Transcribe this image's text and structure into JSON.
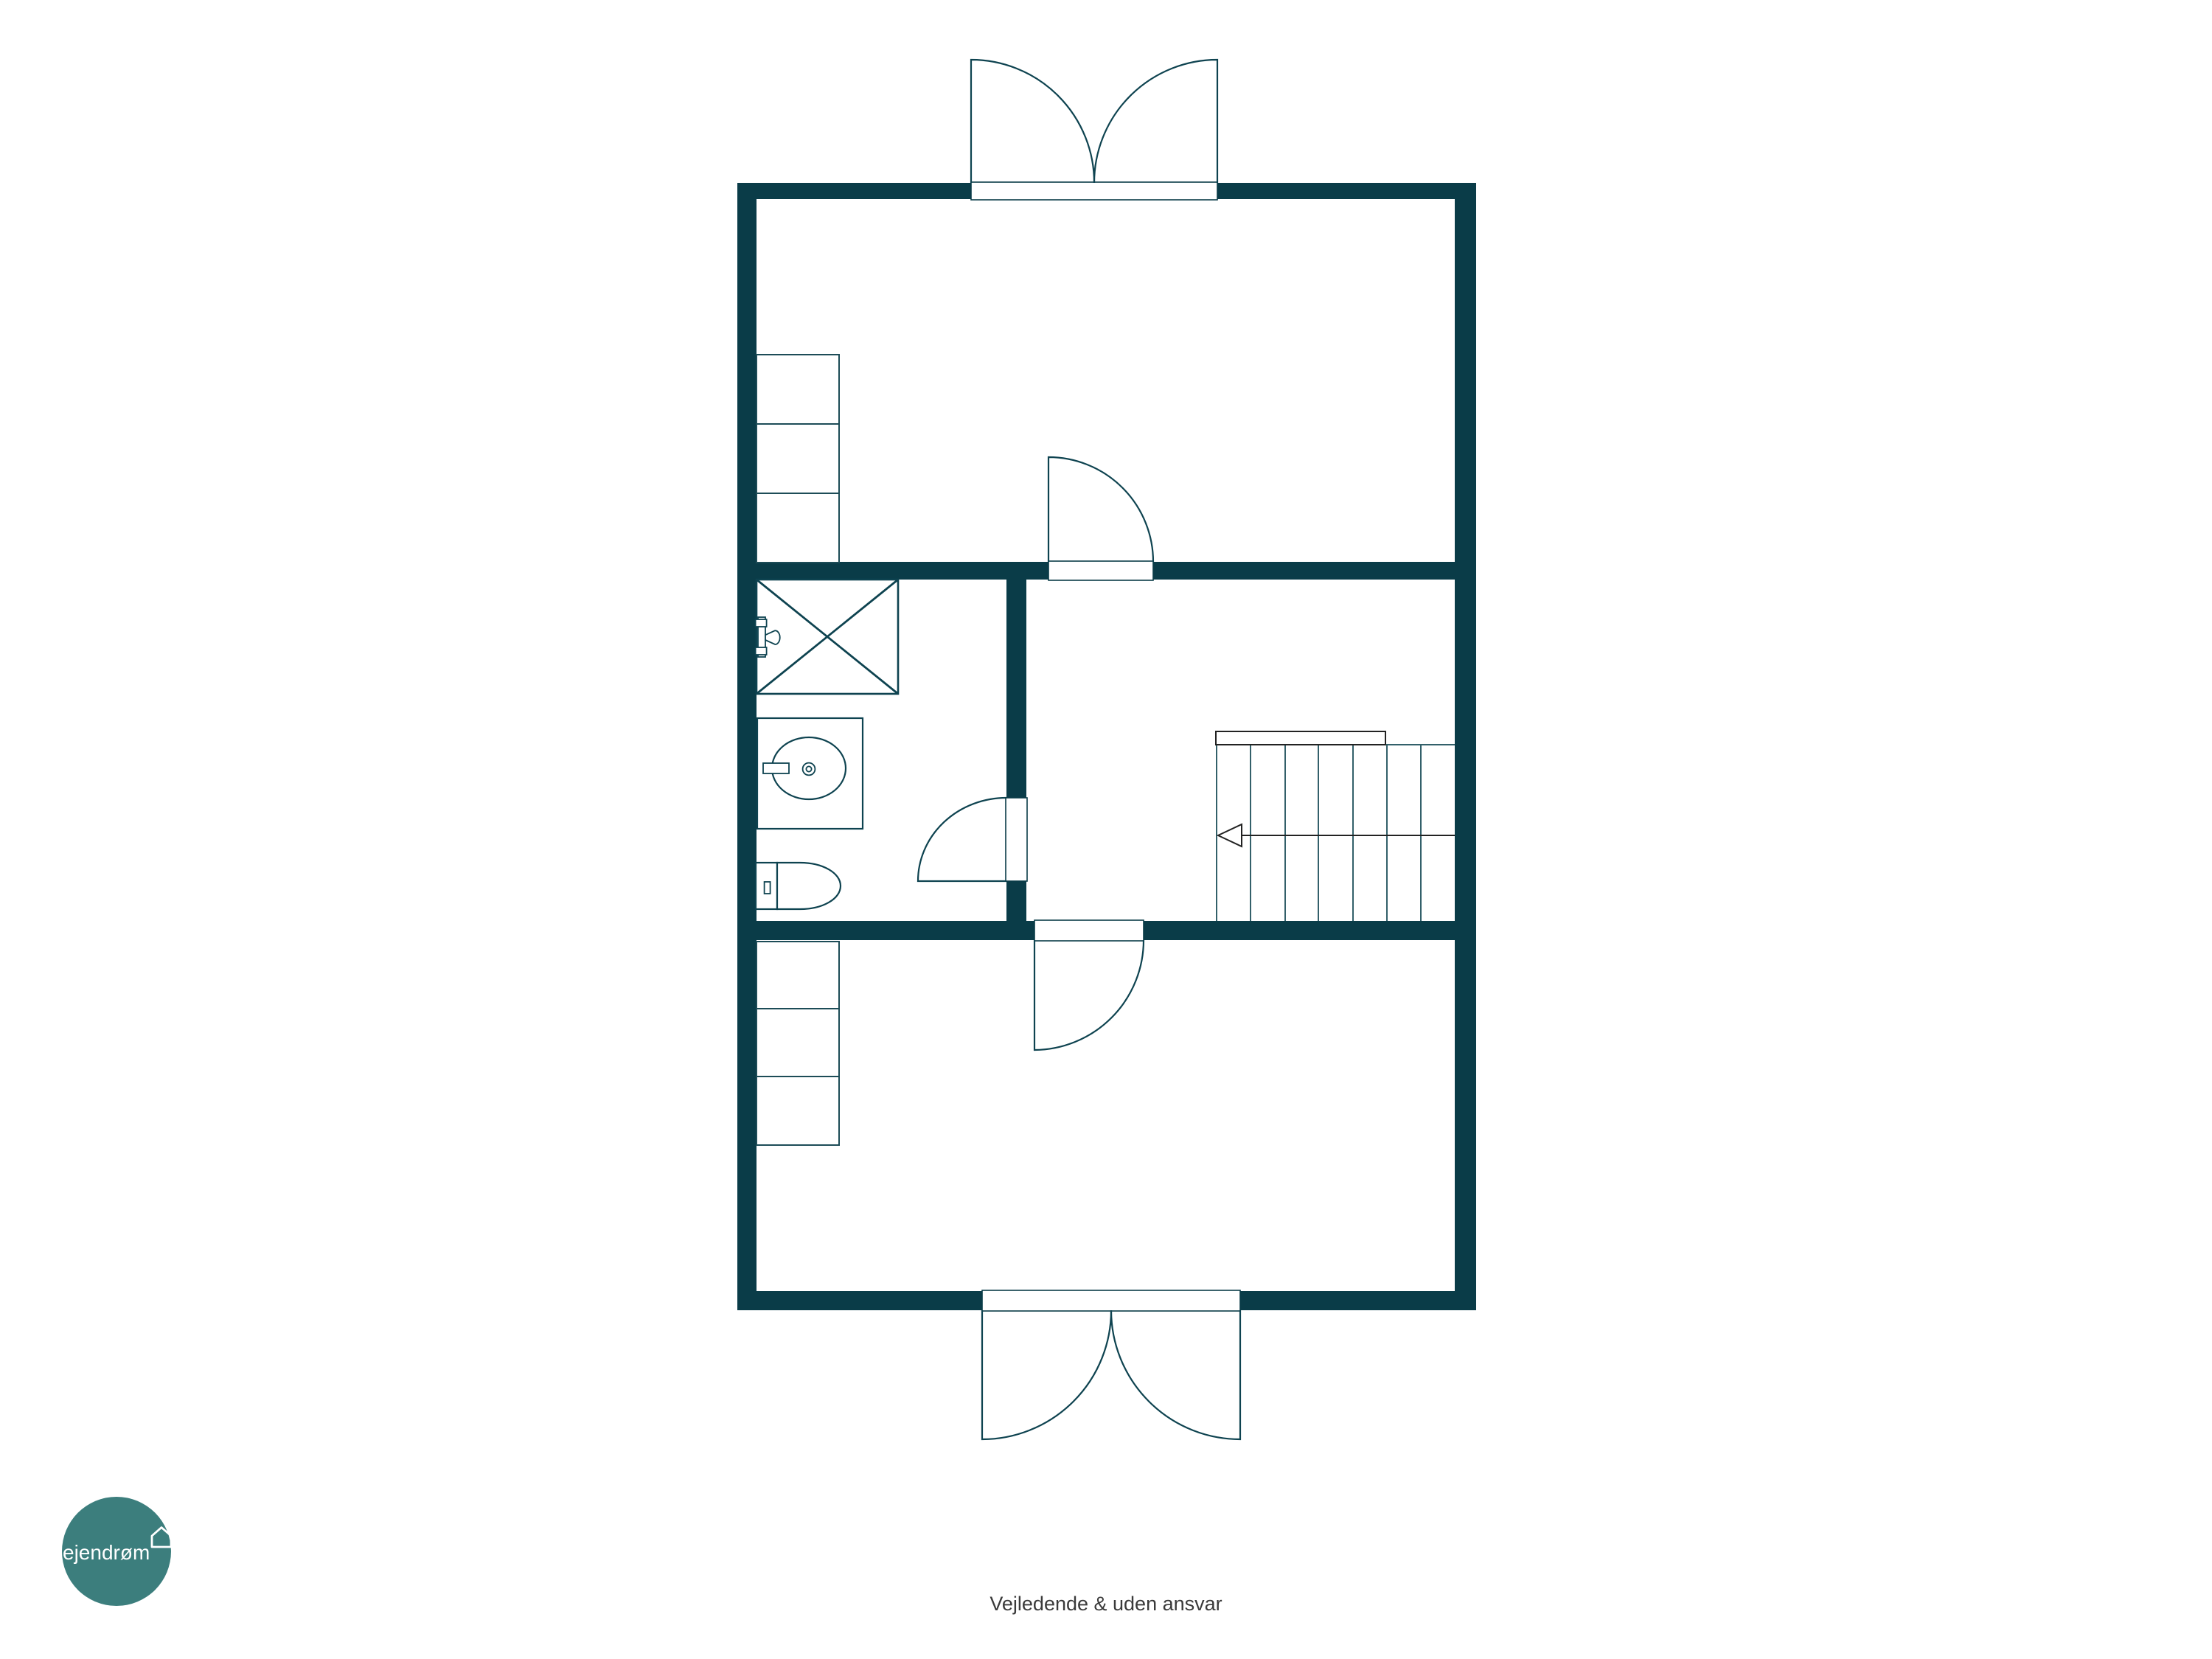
{
  "page": {
    "background_color": "#ffffff"
  },
  "colors": {
    "wall": "#0a3c48",
    "fixture_stroke": "#0e4350",
    "stair_steps": "#33606a",
    "stair_detail": "#222222",
    "logo_circle": "#3c7e7d",
    "logo_text": "#ffffff",
    "footer_text": "#3a3a3a"
  },
  "logo": {
    "text": "ejendrøm",
    "icon": "house-icon"
  },
  "footer": {
    "disclaimer": "Vejledende & uden ansvar"
  },
  "floorplan": {
    "type": "floor-plan",
    "levels": 1,
    "rooms": [
      {
        "name": "top-room",
        "fixtures": [
          "wardrobe-3-sections",
          "double-entry-door-top",
          "interior-door-to-hallway"
        ]
      },
      {
        "name": "bathroom",
        "fixtures": [
          "shower-with-x",
          "shower-mixer-tap",
          "sink-basin",
          "toilet",
          "door-to-hallway"
        ]
      },
      {
        "name": "hallway",
        "fixtures": [
          "staircase-7-treads",
          "stair-direction-arrow-left",
          "stair-handrail"
        ]
      },
      {
        "name": "bottom-room",
        "fixtures": [
          "wardrobe-3-sections",
          "double-entry-door-bottom",
          "interior-door-to-hallway"
        ]
      }
    ]
  }
}
